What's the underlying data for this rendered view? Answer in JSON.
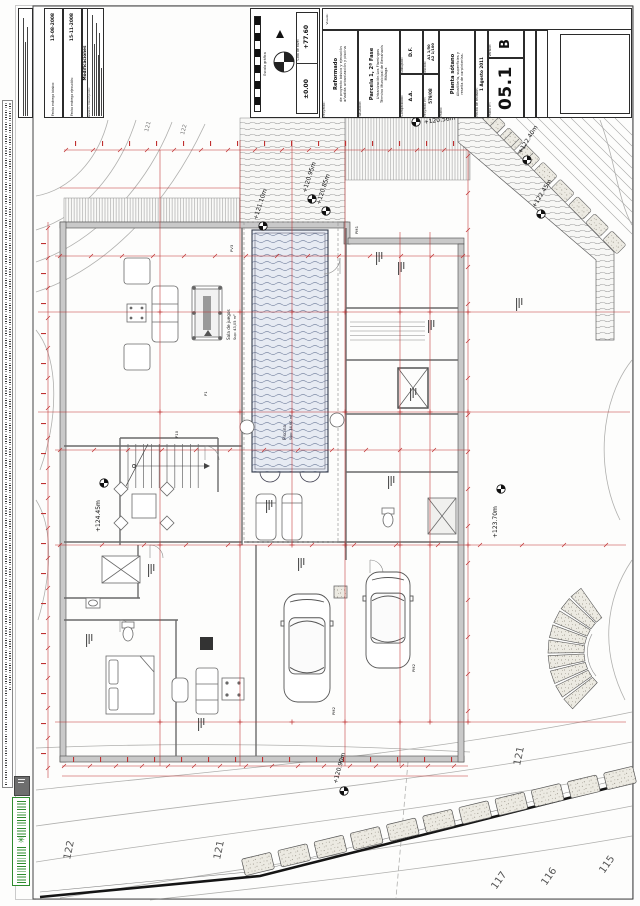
{
  "revisions": {
    "fecha_basico_label": "Fecha entrega básico:",
    "fecha_basico_value": "13-08-2008",
    "fecha_ejecucion_label": "Fecha entrega ejecución:",
    "fecha_ejecucion_value": "15-11-2008",
    "modificaciones_title": "Modificaciones",
    "revision_header": "Revisión:   Descripción:"
  },
  "datum": {
    "escala_grafica": "Escala gráfica",
    "cota_nivel": "Cota de nivel",
    "cota_cero": "±0.00",
    "cota_valor": "+77.60"
  },
  "title_block": {
    "visado_label": "Visado:",
    "proyecto_label": "Proyecto:",
    "proyecto_title": "Reformado",
    "proyecto_sub1": "de proyecto básico y ejecución",
    "proyecto_sub2": "añadida urbanización y piscina",
    "situacion_label": "Situación:",
    "situacion_title": "Parcela 1, 2ª Fase",
    "situacion_sub1": "Urbanización Los Flamingos",
    "situacion_sub2": "Término Municipal de Benahavís",
    "situacion_sub3": "Málaga",
    "dibujado_label": "Dibujado:",
    "dibujado_value": "D.F.",
    "comprobado_label": "Comprobado:",
    "comprobado_value": "A.A.",
    "escala_label": "Escala:",
    "escala_value1": "A1 1/50",
    "escala_value2": "A2 1/100",
    "proyecto_num_label": "Proyecto nº:",
    "proyecto_num_value": "579/08",
    "plano_label": "Plano:",
    "plano_title": "Planta sótano",
    "plano_sub1": "Albañilería, superficies y",
    "plano_sub2": "reseña de carpinterías.",
    "fecha_label": "Fecha de revisión:",
    "fecha_value": "1 Agosto 2011",
    "plano_num_label": "Plano nº:",
    "plano_num_value": "05.1",
    "version_label": "Versión:",
    "version_value": "B"
  },
  "plan": {
    "levels": [
      "+120.56m",
      "+120.95m",
      "+120.85m",
      "+121.10m",
      "+122.40m",
      "+122.45m",
      "+124.45m",
      "+123.70m",
      "+120.90m"
    ],
    "contours": [
      "121",
      "122",
      "122",
      "121",
      "121",
      "117",
      "116",
      "115"
    ],
    "rooms": {
      "sala_juegos": "Sala de juegos",
      "sala_juegos_sup": "Sup: 43,05 m²",
      "piscina": "Piscina",
      "piscina_sup": "Sup: 34,60 m²"
    },
    "doors": [
      "PV3",
      "PM1",
      "P1",
      "P10",
      "PM2",
      "PM2"
    ]
  }
}
